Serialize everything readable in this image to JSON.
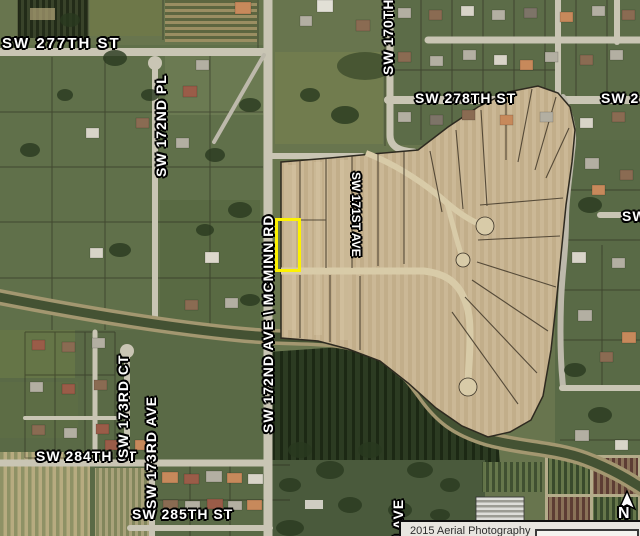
{
  "map": {
    "labels": {
      "sw277": "SW 277TH ST",
      "sw172pl": "SW 172ND PL",
      "sw170_fragment": "SW 170TH",
      "sw278": "SW 278TH ST",
      "sw278_fragment": "SW 2",
      "mcminn": "SW 172ND AVE \\ MCMINN RD",
      "sw171ave": "SW 171ST AVE",
      "sw_fragment_right": "SW",
      "sw173ct": "SW 173RD CT",
      "sw173ave": "SW 173RD AVE",
      "sw284": "SW 284TH ST",
      "sw285": "SW 285TH ST",
      "have_fragment": "H AVE"
    },
    "compass": {
      "north_label": "N"
    },
    "attribution": {
      "text": "2015 Aerial Photography"
    },
    "highlight": {
      "color": "#fdf200"
    }
  }
}
